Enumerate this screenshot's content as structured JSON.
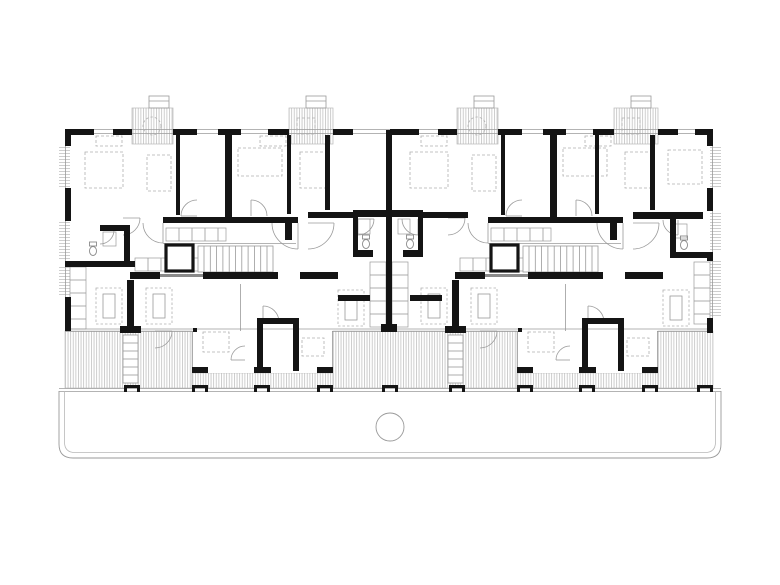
{
  "document": {
    "kind": "architectural-floor-plan",
    "visible_text": []
  },
  "colors": {
    "background": "#ffffff",
    "wall": "#141414",
    "partition": "#8a8a8a",
    "line": "#9a9a9a",
    "faint": "#b8b8b8",
    "hatch": "#c8c8c8",
    "dashed": "#b0b0b0"
  },
  "plan": {
    "canvas": {
      "w": 780,
      "h": 585
    },
    "walls": [
      [
        65,
        129,
        29,
        6
      ],
      [
        113,
        129,
        19,
        6
      ],
      [
        173,
        129,
        24,
        6
      ],
      [
        218,
        129,
        23,
        6
      ],
      [
        268,
        129,
        21,
        6
      ],
      [
        333,
        129,
        20,
        6
      ],
      [
        390,
        129,
        29,
        6
      ],
      [
        438,
        129,
        19,
        6
      ],
      [
        498,
        129,
        24,
        6
      ],
      [
        543,
        129,
        23,
        6
      ],
      [
        593,
        129,
        21,
        6
      ],
      [
        658,
        129,
        20,
        6
      ],
      [
        695,
        129,
        18,
        6
      ],
      [
        65,
        129,
        6,
        17
      ],
      [
        65,
        188,
        6,
        33
      ],
      [
        65,
        297,
        6,
        34
      ],
      [
        707,
        129,
        6,
        17
      ],
      [
        707,
        188,
        6,
        23
      ],
      [
        707,
        252,
        6,
        9
      ],
      [
        707,
        318,
        6,
        15
      ],
      [
        176,
        135,
        4,
        80
      ],
      [
        225,
        133,
        7,
        89
      ],
      [
        287,
        135,
        4,
        79
      ],
      [
        325,
        135,
        5,
        75
      ],
      [
        501,
        135,
        4,
        80
      ],
      [
        550,
        133,
        7,
        89
      ],
      [
        595,
        135,
        4,
        79
      ],
      [
        650,
        135,
        5,
        75
      ],
      [
        386,
        130,
        6,
        196
      ],
      [
        381,
        324,
        16,
        8
      ],
      [
        163,
        217,
        135,
        6
      ],
      [
        285,
        222,
        7,
        18
      ],
      [
        308,
        212,
        45,
        6
      ],
      [
        423,
        212,
        45,
        6
      ],
      [
        488,
        217,
        135,
        6
      ],
      [
        610,
        222,
        7,
        18
      ],
      [
        633,
        212,
        70,
        7
      ],
      [
        353,
        210,
        70,
        7
      ],
      [
        353,
        217,
        5,
        36
      ],
      [
        418,
        217,
        5,
        36
      ],
      [
        353,
        250,
        20,
        7
      ],
      [
        403,
        250,
        20,
        7
      ],
      [
        100,
        225,
        28,
        6
      ],
      [
        124,
        225,
        6,
        42
      ],
      [
        65,
        261,
        70,
        6
      ],
      [
        670,
        212,
        6,
        46
      ],
      [
        670,
        252,
        40,
        6
      ],
      [
        130,
        272,
        30,
        7
      ],
      [
        203,
        272,
        75,
        7
      ],
      [
        300,
        272,
        38,
        7
      ],
      [
        455,
        272,
        30,
        7
      ],
      [
        528,
        272,
        75,
        7
      ],
      [
        625,
        272,
        38,
        7
      ],
      [
        338,
        295,
        32,
        6
      ],
      [
        410,
        295,
        32,
        6
      ],
      [
        127,
        280,
        7,
        51
      ],
      [
        120,
        326,
        21,
        7
      ],
      [
        452,
        280,
        7,
        51
      ],
      [
        445,
        326,
        21,
        7
      ],
      [
        257,
        318,
        6,
        53
      ],
      [
        257,
        318,
        41,
        6
      ],
      [
        293,
        318,
        6,
        53
      ],
      [
        192,
        367,
        16,
        6
      ],
      [
        254,
        367,
        17,
        6
      ],
      [
        317,
        367,
        16,
        6
      ],
      [
        193,
        328,
        4,
        4
      ],
      [
        582,
        318,
        6,
        53
      ],
      [
        582,
        318,
        41,
        6
      ],
      [
        618,
        318,
        6,
        53
      ],
      [
        517,
        367,
        16,
        6
      ],
      [
        579,
        367,
        17,
        6
      ],
      [
        642,
        367,
        16,
        6
      ],
      [
        518,
        328,
        4,
        4
      ]
    ],
    "partitions": [
      [
        160,
        274,
        43,
        3
      ],
      [
        485,
        274,
        43,
        3
      ]
    ],
    "balconies": [
      [
        132,
        108,
        41,
        36
      ],
      [
        289,
        108,
        44,
        36
      ],
      [
        457,
        108,
        41,
        36
      ],
      [
        614,
        108,
        44,
        36
      ]
    ],
    "balcony_caps": [
      [
        149,
        96,
        20,
        12
      ],
      [
        306,
        96,
        20,
        12
      ],
      [
        474,
        96,
        20,
        12
      ],
      [
        631,
        96,
        20,
        12
      ]
    ],
    "terraces": [
      [
        65,
        331,
        127,
        57
      ],
      [
        333,
        331,
        184,
        57
      ],
      [
        658,
        331,
        55,
        57
      ],
      [
        192,
        373,
        141,
        15
      ],
      [
        517,
        373,
        141,
        15
      ]
    ],
    "side_windows": [
      [
        59,
        146,
        11,
        41
      ],
      [
        59,
        221,
        11,
        40
      ],
      [
        59,
        266,
        11,
        30
      ],
      [
        710,
        146,
        11,
        41
      ],
      [
        710,
        211,
        11,
        40
      ],
      [
        710,
        261,
        11,
        56
      ]
    ],
    "white_blocks": [
      [
        193,
        331,
        139,
        42
      ],
      [
        518,
        331,
        139,
        42
      ]
    ],
    "lines": [
      [
        65,
        129.5,
        713,
        129.5
      ],
      [
        65,
        133.5,
        713,
        133.5
      ],
      [
        65,
        329,
        713,
        329
      ],
      [
        65,
        331.5,
        713,
        331.5
      ],
      [
        59,
        388.5,
        721,
        388.5
      ],
      [
        59,
        391.5,
        721,
        391.5
      ],
      [
        65.5,
        130,
        65.5,
        331
      ],
      [
        712.5,
        130,
        712.5,
        331
      ],
      [
        192.5,
        331,
        192.5,
        373
      ],
      [
        332.5,
        331,
        332.5,
        373
      ],
      [
        192,
        372.5,
        333,
        372.5
      ],
      [
        517.5,
        331,
        517.5,
        373
      ],
      [
        657.5,
        331,
        657.5,
        373
      ],
      [
        517,
        372.5,
        658,
        372.5
      ],
      [
        240.5,
        284,
        240.5,
        368
      ],
      [
        565.5,
        284,
        565.5,
        368
      ],
      [
        163,
        243.5,
        296,
        243.5
      ],
      [
        488,
        243.5,
        621,
        243.5
      ]
    ],
    "footing_marks": {
      "xs": [
        124,
        192,
        254,
        317,
        382,
        449,
        517,
        579,
        642,
        697
      ],
      "y": 385
    },
    "elevators": [
      [
        166,
        245,
        27,
        26
      ],
      [
        491,
        245,
        27,
        26
      ]
    ],
    "stairs": [
      [
        198,
        246,
        75,
        26
      ],
      [
        523,
        246,
        75,
        26
      ]
    ],
    "terrace_stairs": [
      [
        123,
        335,
        15,
        48
      ],
      [
        448,
        335,
        15,
        48
      ]
    ],
    "counters": [
      [
        166,
        228,
        60,
        13,
        "h"
      ],
      [
        491,
        228,
        60,
        13,
        "h"
      ],
      [
        135,
        258,
        65,
        13,
        "h"
      ],
      [
        460,
        258,
        65,
        13,
        "h"
      ],
      [
        370,
        262,
        16,
        65,
        "v"
      ],
      [
        392,
        262,
        16,
        65,
        "v"
      ],
      [
        70,
        267,
        16,
        62,
        "v"
      ],
      [
        694,
        262,
        16,
        62,
        "v"
      ],
      [
        358,
        219,
        12,
        15,
        "v"
      ],
      [
        398,
        219,
        12,
        15,
        "v"
      ],
      [
        103,
        232,
        13,
        14,
        "h"
      ],
      [
        674,
        224,
        13,
        14,
        "h"
      ]
    ],
    "furniture_dashed": [
      [
        85,
        152,
        38,
        36
      ],
      [
        147,
        155,
        24,
        36
      ],
      [
        238,
        148,
        44,
        28
      ],
      [
        300,
        152,
        28,
        36
      ],
      [
        410,
        152,
        38,
        36
      ],
      [
        472,
        155,
        24,
        36
      ],
      [
        563,
        148,
        44,
        28
      ],
      [
        625,
        152,
        28,
        36
      ],
      [
        668,
        150,
        34,
        34
      ],
      [
        96,
        136,
        26,
        10
      ],
      [
        260,
        136,
        26,
        10
      ],
      [
        421,
        136,
        26,
        10
      ],
      [
        585,
        136,
        26,
        10
      ],
      [
        203,
        332,
        26,
        20
      ],
      [
        302,
        338,
        22,
        18
      ],
      [
        528,
        332,
        26,
        20
      ],
      [
        627,
        338,
        22,
        18
      ],
      [
        297,
        118,
        18,
        16
      ],
      [
        622,
        118,
        18,
        16
      ]
    ],
    "tables": [
      [
        96,
        288
      ],
      [
        146,
        288
      ],
      [
        338,
        290
      ],
      [
        421,
        288
      ],
      [
        471,
        288
      ],
      [
        663,
        290
      ]
    ],
    "table_size": [
      26,
      36
    ],
    "balcony_tables": [
      [
        152,
        126,
        9
      ],
      [
        477,
        126,
        9
      ]
    ],
    "toilets": [
      [
        366,
        244
      ],
      [
        410,
        244
      ],
      [
        93,
        251
      ],
      [
        684,
        245
      ]
    ],
    "door_arcs": [
      [
        298,
        223,
        26,
        90
      ],
      [
        308,
        223,
        26,
        0
      ],
      [
        623,
        223,
        26,
        90
      ],
      [
        633,
        223,
        26,
        0
      ],
      [
        197,
        216,
        16,
        180
      ],
      [
        251,
        216,
        16,
        270
      ],
      [
        522,
        216,
        16,
        180
      ],
      [
        576,
        216,
        16,
        270
      ],
      [
        163,
        223,
        20,
        90
      ],
      [
        488,
        223,
        20,
        90
      ],
      [
        358,
        219,
        16,
        0
      ],
      [
        418,
        219,
        16,
        90
      ],
      [
        100,
        230,
        14,
        0
      ],
      [
        678,
        220,
        15,
        90
      ],
      [
        123,
        218,
        17,
        0
      ],
      [
        448,
        218,
        17,
        0
      ],
      [
        263,
        322,
        16,
        270
      ],
      [
        245,
        360,
        14,
        180
      ],
      [
        588,
        322,
        16,
        270
      ],
      [
        570,
        360,
        14,
        180
      ],
      [
        155,
        331,
        17,
        0
      ],
      [
        480,
        331,
        17,
        0
      ]
    ],
    "ground_outline": {
      "outer": "M 59 391 L 59 444 Q 59 458 73 458 L 707 458 Q 721 458 721 444 L 721 391",
      "inner": "M 64.5 391 L 64.5 442 Q 64.5 452.5 75 452.5 L 705 452.5 Q 715.5 452.5 715.5 442 L 715.5 391"
    },
    "entrance_circle": [
      390,
      427,
      14
    ]
  }
}
